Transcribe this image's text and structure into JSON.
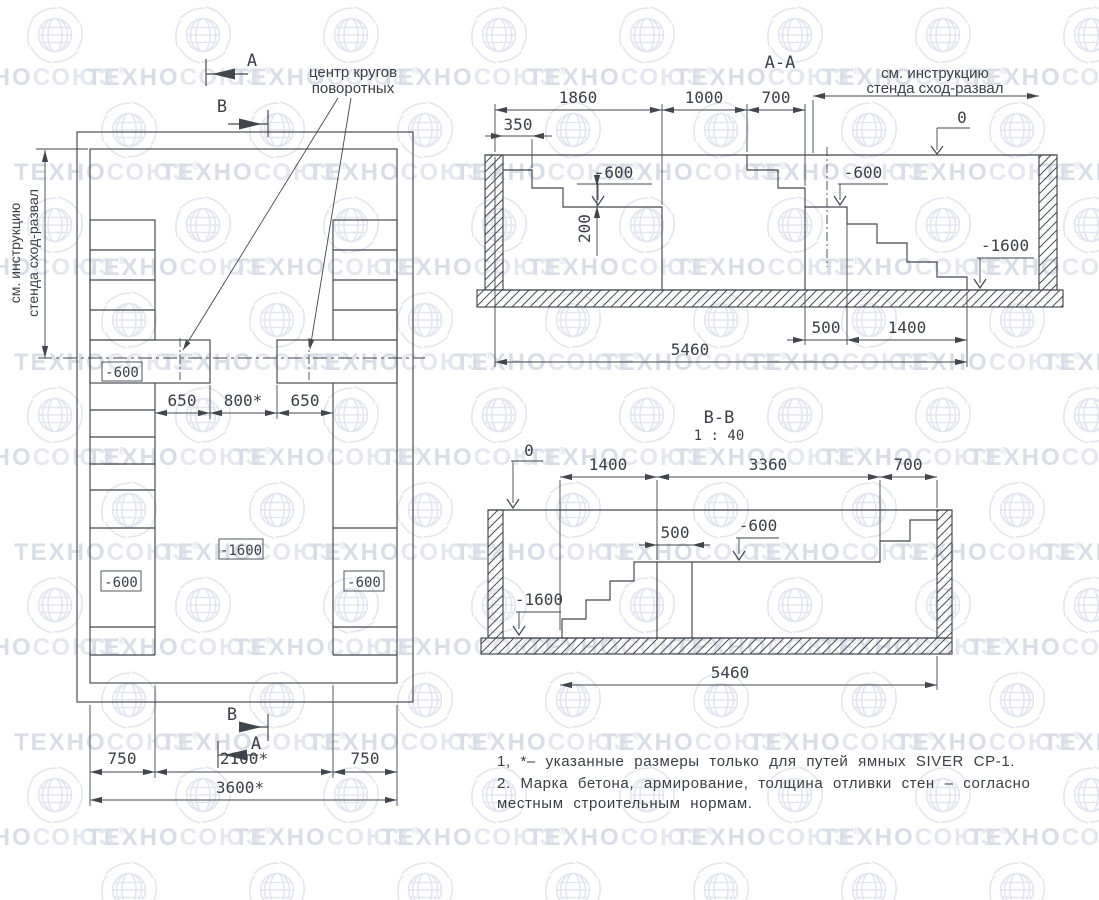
{
  "watermark": {
    "t1": "ТЕХНО",
    "t2": "СОЮЗ",
    "reg": "®"
  },
  "plan": {
    "marker_a": "A",
    "marker_b": "B",
    "center_note1": "центр кругов",
    "center_note2": "поворотных",
    "instr1": "см. инструкцию",
    "instr2": "стенда сход-развал",
    "lvl600_top": "-600",
    "lvl600_left": "-600",
    "lvl600_right": "-600",
    "lvl1600": "-1600",
    "d650a": "650",
    "d800": "800*",
    "d650b": "650",
    "d750a": "750",
    "d2100": "2100*",
    "d750b": "750",
    "d3600": "3600*"
  },
  "section_aa": {
    "title": "А-А",
    "instr1": "см. инструкцию",
    "instr2": "стенда сход-развал",
    "zero": "0",
    "d1860": "1860",
    "d1000": "1000",
    "d700": "700",
    "d350": "350",
    "d200": "200",
    "lvl600a": "-600",
    "lvl600b": "-600",
    "lvl1600": "-1600",
    "d500": "500",
    "d1400": "1400",
    "d5460": "5460"
  },
  "section_bb": {
    "title": "B-B",
    "scale": "1 : 40",
    "zero": "0",
    "d1400": "1400",
    "d3360": "3360",
    "d700": "700",
    "d500": "500",
    "lvl600": "-600",
    "lvl1600": "-1600",
    "d5460": "5460"
  },
  "notes": {
    "line1": "1, *– указанные размеры только для путей ямных SIVER СР-1.",
    "line2": "2. Марка бетона, армирование, толщина отливки стен – согласно",
    "line3": "местным строительным нормам."
  }
}
